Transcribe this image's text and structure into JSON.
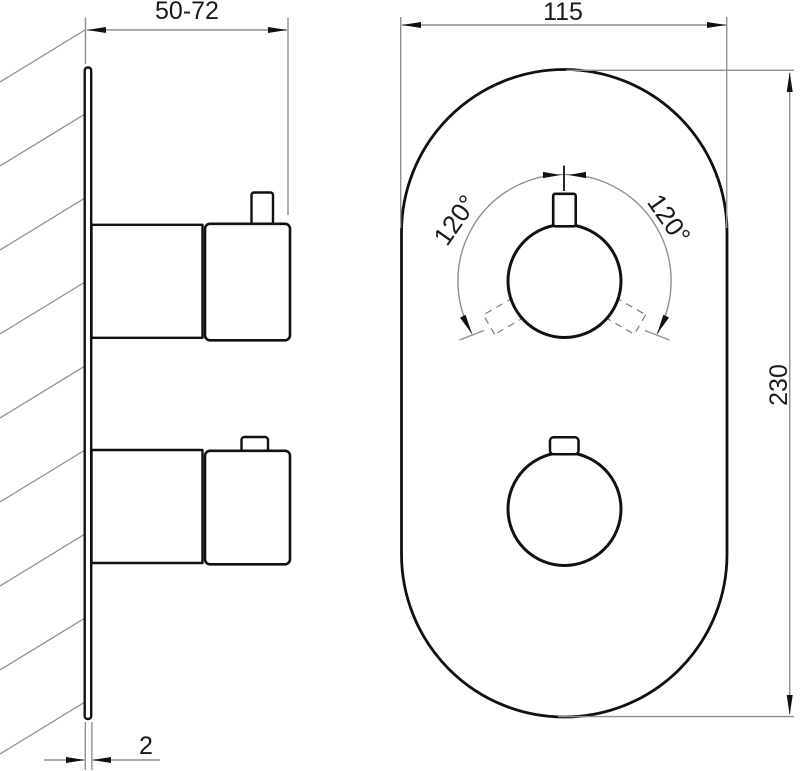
{
  "labels": {
    "wall_offset": "50-72",
    "plate_width": "115",
    "plate_height": "230",
    "plate_thickness": "2",
    "rotation_left": "120°",
    "rotation_right": "120°"
  },
  "colors": {
    "bg": "#ffffff",
    "line": "#111111",
    "thin": "#8f8f8f",
    "text": "#1a1a1a"
  }
}
